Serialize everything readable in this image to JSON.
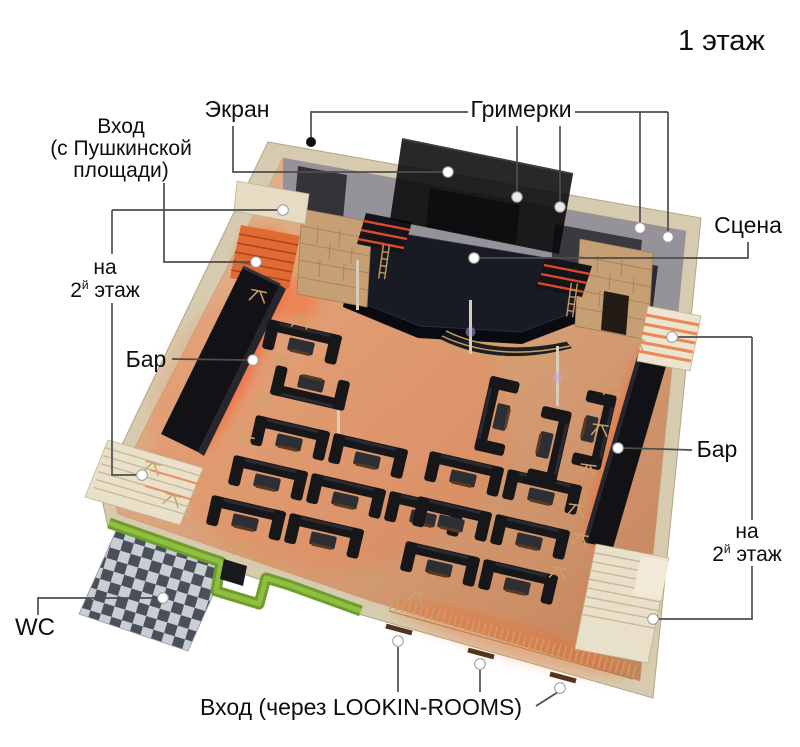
{
  "title": "1 этаж",
  "labels": {
    "screen": "Экран",
    "dressing_rooms": "Гримерки",
    "entrance_top": {
      "line1": "Вход",
      "line2": "(с Пушкинской",
      "line3": "площади)"
    },
    "stage": "Сцена",
    "to_second_floor": {
      "word1": "на",
      "num": "2",
      "sup": "й",
      "word2": "этаж"
    },
    "bar": "Бар",
    "wc": "WC",
    "entrance_bottom": "Вход (через LOOKIN-ROOMS)"
  },
  "colors": {
    "wall_beige": "#d7cbaf",
    "floor_wood": "#d89e74",
    "glow_orange": "#ff5a22",
    "stage_dark": "#181a24",
    "couch_black": "#17171a",
    "green_wall": "#7fae36",
    "checker_dark": "#49505a",
    "checker_light": "#c9ced3",
    "gray_backstage": "#95929a",
    "stone": "#c79f74",
    "callout_line": "#4d4d4d"
  }
}
